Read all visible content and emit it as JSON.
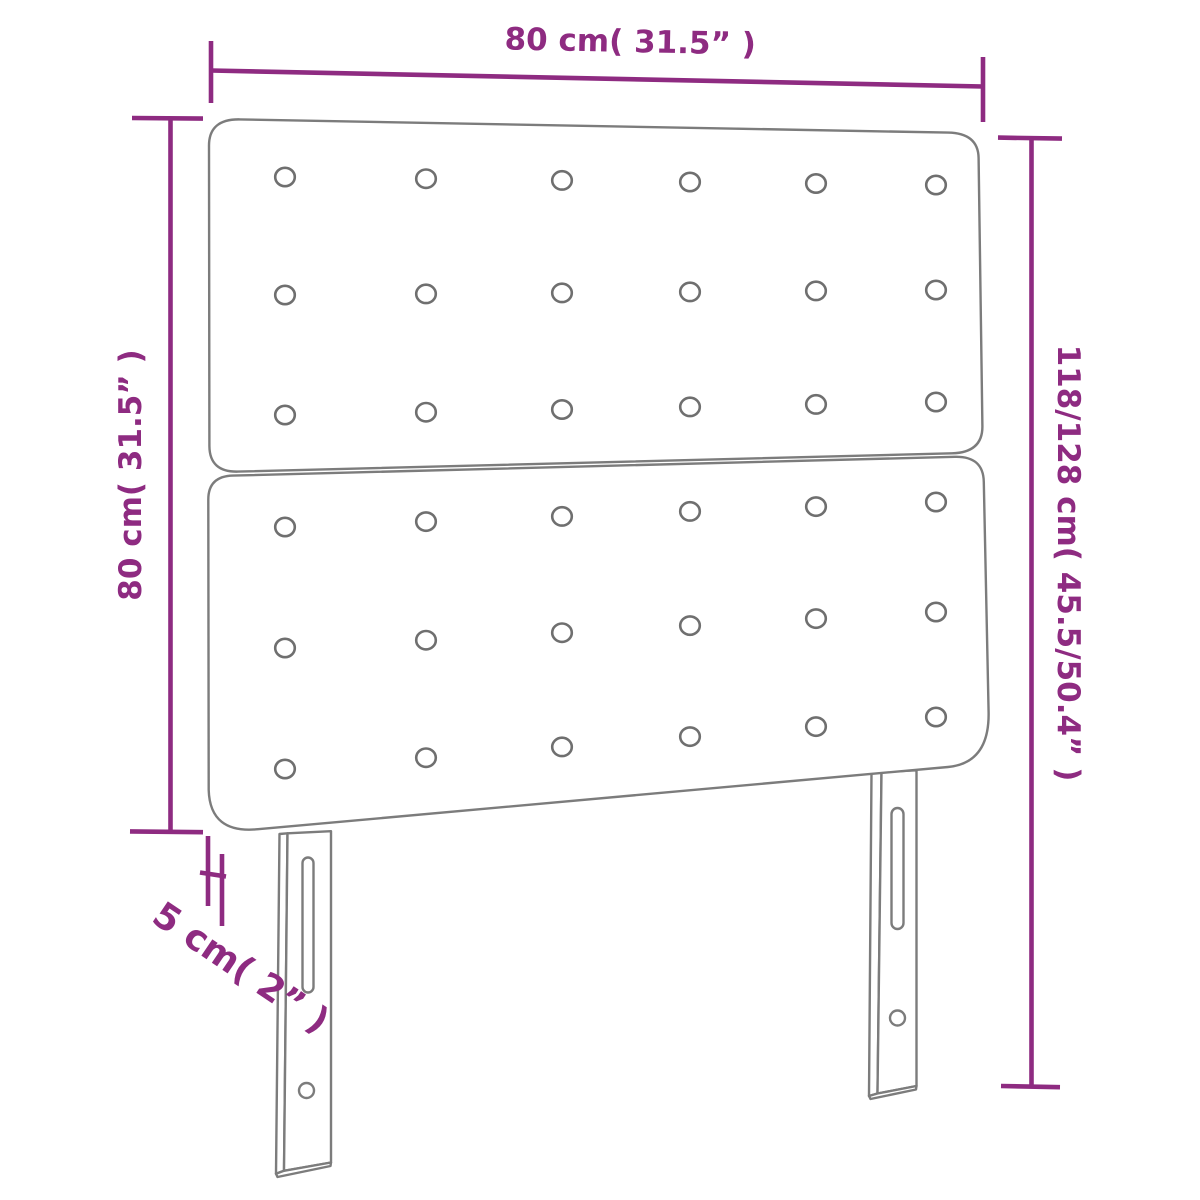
{
  "diagram": {
    "labels": {
      "width": "80 cm( 31.5” )",
      "height_left": "80 cm( 31.5” )",
      "height_right": "118/128 cm( 45.5/50.4” )",
      "thickness": "5 cm( 2” )"
    },
    "tufting_button_grid": {
      "panels": [
        "top",
        "bottom"
      ],
      "rows_per_panel": 3,
      "columns_per_row": 6
    },
    "legs_count": 2,
    "colors": {
      "dimension": "#8e2b81",
      "outline": "#7c7c7c",
      "button": "#6f6f6f",
      "background": "#ffffff"
    }
  }
}
